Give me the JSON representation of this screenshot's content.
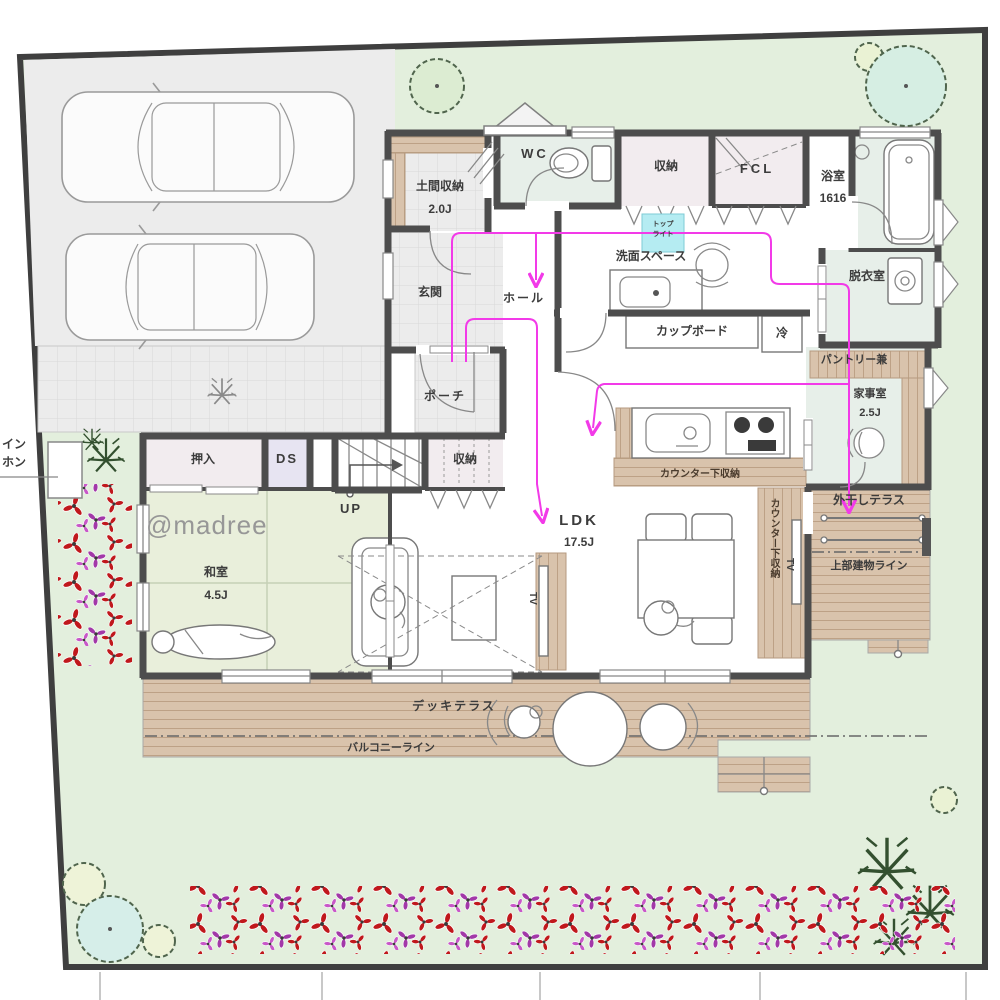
{
  "colors": {
    "garden": "#e3efdd",
    "paving": "#ececec",
    "wood": "#d9c3ac",
    "tatami": "#e9efdb",
    "sanitary": "#e7efe9",
    "closet": "#f2ecef",
    "ds": "#e7e4f2",
    "sky": "#b5ecf2",
    "wall": "#4d4d4d",
    "flow": "#f23ae8"
  },
  "labels": {
    "doma": "土間収納",
    "doma_size": "2.0J",
    "wc": "WC",
    "closet_top": "収納",
    "fcl": "FCL",
    "bath": "浴室",
    "bath_size": "1616",
    "genkan": "玄関",
    "hall": "ホール",
    "senmen": "洗面スペース",
    "datsui": "脱衣室",
    "cupboard": "カップボード",
    "rei": "冷",
    "pantry1": "パントリー兼",
    "pantry2": "家事室",
    "pantry_size": "2.5J",
    "porch": "ポーチ",
    "oshiire": "押入",
    "ds": "DS",
    "up": "UP",
    "closet_stairs": "収納",
    "ldk": "LDK",
    "ldk_size": "17.5J",
    "counter_storage": "カウンター下収納",
    "counter_storage_side": "カウンター下収納",
    "tv_living": "TV",
    "tv_dining": "TV",
    "drying_terrace": "外干しテラス",
    "upper_building_line": "上部建物ライン",
    "washitsu": "和室",
    "washitsu_size": "4.5J",
    "deck": "デッキテラス",
    "balcony_line": "バルコニーライン",
    "skylight1": "トップ",
    "skylight2": "ライト",
    "cut_text1": "イン",
    "cut_text2": "ホン",
    "watermark": "@madree"
  }
}
